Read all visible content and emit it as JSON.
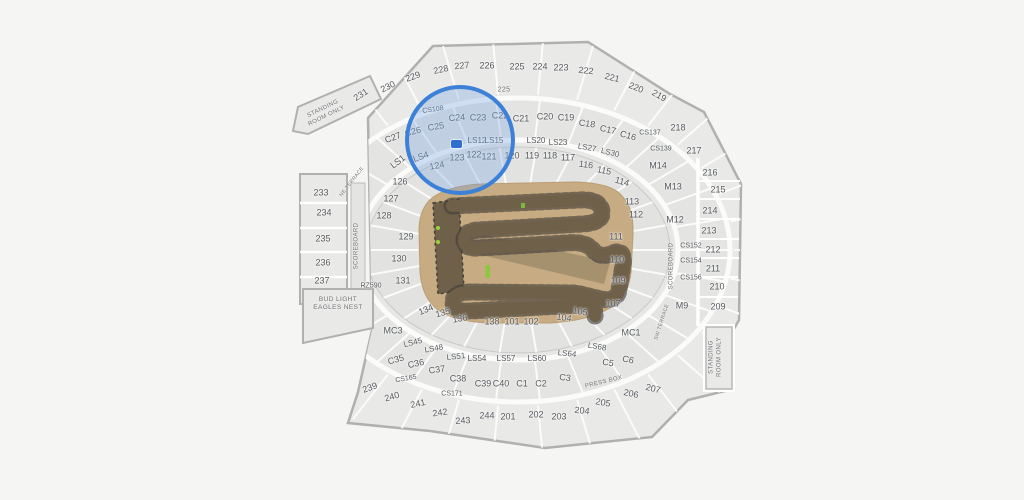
{
  "map": {
    "colors": {
      "background": "#f5f5f3",
      "section_fill": "#e9e9e7",
      "section_stroke": "#b0b0ae",
      "label": "#55585d",
      "highlight_stroke": "#3c80d8",
      "highlight_fill": "rgba(126,168,226,0.35)",
      "marker": "#2e6fd0",
      "field_base": "#c7ab82",
      "track": "#6e6049",
      "track_edge": "#45403a",
      "start_gate_green": "#8dc63f"
    },
    "highlight": {
      "cx": 460,
      "cy": 140,
      "r": 55,
      "marker_x": 456,
      "marker_y": 144
    },
    "sections": [
      {
        "l": "231",
        "x": 361,
        "y": 95,
        "r": -33
      },
      {
        "l": "230",
        "x": 388,
        "y": 87,
        "r": -27
      },
      {
        "l": "229",
        "x": 413,
        "y": 77,
        "r": -20
      },
      {
        "l": "228",
        "x": 441,
        "y": 70,
        "r": -12
      },
      {
        "l": "227",
        "x": 462,
        "y": 66,
        "r": -6
      },
      {
        "l": "226",
        "x": 487,
        "y": 66,
        "r": 0
      },
      {
        "l": "225",
        "x": 517,
        "y": 67,
        "r": 0
      },
      {
        "l": "224",
        "x": 540,
        "y": 67,
        "r": 0
      },
      {
        "l": "223",
        "x": 561,
        "y": 68,
        "r": 0
      },
      {
        "l": "222",
        "x": 586,
        "y": 71,
        "r": 6
      },
      {
        "l": "221",
        "x": 612,
        "y": 78,
        "r": 14
      },
      {
        "l": "220",
        "x": 636,
        "y": 88,
        "r": 22
      },
      {
        "l": "219",
        "x": 659,
        "y": 96,
        "r": 30
      },
      {
        "l": "CS108",
        "x": 433,
        "y": 110,
        "r": -8
      },
      {
        "l": "C25",
        "x": 436,
        "y": 127,
        "r": -10
      },
      {
        "l": "C26",
        "x": 413,
        "y": 132,
        "r": -14
      },
      {
        "l": "C27",
        "x": 393,
        "y": 138,
        "r": -20
      },
      {
        "l": "C24",
        "x": 457,
        "y": 118,
        "r": -4
      },
      {
        "l": "C23",
        "x": 478,
        "y": 118,
        "r": 0
      },
      {
        "l": "C22",
        "x": 500,
        "y": 116,
        "r": 0
      },
      {
        "l": "C21",
        "x": 521,
        "y": 119,
        "r": 0
      },
      {
        "l": "C20",
        "x": 545,
        "y": 117,
        "r": 0
      },
      {
        "l": "C19",
        "x": 566,
        "y": 118,
        "r": 0
      },
      {
        "l": "C18",
        "x": 587,
        "y": 124,
        "r": 8
      },
      {
        "l": "C17",
        "x": 608,
        "y": 130,
        "r": 12
      },
      {
        "l": "C16",
        "x": 628,
        "y": 136,
        "r": 16
      },
      {
        "l": "CS137",
        "x": 650,
        "y": 133,
        "r": 0
      },
      {
        "l": "CS139",
        "x": 661,
        "y": 149,
        "r": 0
      },
      {
        "l": "LS1",
        "x": 398,
        "y": 162,
        "r": -38
      },
      {
        "l": "LS4",
        "x": 421,
        "y": 157,
        "r": -20
      },
      {
        "l": "LS12",
        "x": 477,
        "y": 141,
        "r": 0
      },
      {
        "l": "LS15",
        "x": 494,
        "y": 141,
        "r": 0
      },
      {
        "l": "LS20",
        "x": 536,
        "y": 141,
        "r": 0
      },
      {
        "l": "LS23",
        "x": 558,
        "y": 143,
        "r": 0
      },
      {
        "l": "LS27",
        "x": 587,
        "y": 148,
        "r": 10
      },
      {
        "l": "LS30",
        "x": 610,
        "y": 153,
        "r": 14
      },
      {
        "l": "126",
        "x": 400,
        "y": 182,
        "r": 0
      },
      {
        "l": "127",
        "x": 391,
        "y": 199,
        "r": 0
      },
      {
        "l": "128",
        "x": 384,
        "y": 216,
        "r": 0
      },
      {
        "l": "129",
        "x": 406,
        "y": 237,
        "r": 0
      },
      {
        "l": "130",
        "x": 399,
        "y": 259,
        "r": 0
      },
      {
        "l": "131",
        "x": 403,
        "y": 281,
        "r": 0
      },
      {
        "l": "124",
        "x": 437,
        "y": 166,
        "r": -10
      },
      {
        "l": "123",
        "x": 457,
        "y": 158,
        "r": 0
      },
      {
        "l": "122",
        "x": 474,
        "y": 155,
        "r": 0
      },
      {
        "l": "121",
        "x": 489,
        "y": 157,
        "r": 0
      },
      {
        "l": "120",
        "x": 512,
        "y": 156,
        "r": 0
      },
      {
        "l": "119",
        "x": 532,
        "y": 156,
        "r": 0
      },
      {
        "l": "118",
        "x": 550,
        "y": 156,
        "r": 0
      },
      {
        "l": "117",
        "x": 568,
        "y": 158,
        "r": 0
      },
      {
        "l": "116",
        "x": 586,
        "y": 165,
        "r": 8
      },
      {
        "l": "115",
        "x": 604,
        "y": 171,
        "r": 12
      },
      {
        "l": "114",
        "x": 622,
        "y": 182,
        "r": 16
      },
      {
        "l": "113",
        "x": 632,
        "y": 202,
        "r": 0
      },
      {
        "l": "112",
        "x": 636,
        "y": 215,
        "r": 0
      },
      {
        "l": "111",
        "x": 616,
        "y": 237,
        "r": 0
      },
      {
        "l": "110",
        "x": 617,
        "y": 260,
        "r": 0
      },
      {
        "l": "109",
        "x": 618,
        "y": 281,
        "r": 0
      },
      {
        "l": "107",
        "x": 613,
        "y": 304,
        "r": 0
      },
      {
        "l": "105",
        "x": 580,
        "y": 312,
        "r": 10
      },
      {
        "l": "104",
        "x": 564,
        "y": 318,
        "r": 8
      },
      {
        "l": "101",
        "x": 512,
        "y": 322,
        "r": 0
      },
      {
        "l": "102",
        "x": 531,
        "y": 322,
        "r": 0
      },
      {
        "l": "138",
        "x": 492,
        "y": 322,
        "r": 0
      },
      {
        "l": "136",
        "x": 460,
        "y": 319,
        "r": -10
      },
      {
        "l": "135",
        "x": 443,
        "y": 313,
        "r": -16
      },
      {
        "l": "134",
        "x": 426,
        "y": 310,
        "r": -22
      },
      {
        "l": "M14",
        "x": 658,
        "y": 166,
        "r": 0
      },
      {
        "l": "M13",
        "x": 673,
        "y": 187,
        "r": 0
      },
      {
        "l": "M12",
        "x": 675,
        "y": 220,
        "r": 0
      },
      {
        "l": "M9",
        "x": 682,
        "y": 306,
        "r": 0
      },
      {
        "l": "MC1",
        "x": 631,
        "y": 333,
        "r": 0
      },
      {
        "l": "MC3",
        "x": 393,
        "y": 331,
        "r": 0
      },
      {
        "l": "RZ590",
        "x": 371,
        "y": 286,
        "r": 0
      },
      {
        "l": "CS152",
        "x": 691,
        "y": 246,
        "r": 0
      },
      {
        "l": "CS154",
        "x": 691,
        "y": 261,
        "r": 0
      },
      {
        "l": "CS156",
        "x": 691,
        "y": 278,
        "r": 0
      },
      {
        "l": "218",
        "x": 678,
        "y": 128,
        "r": 0
      },
      {
        "l": "217",
        "x": 694,
        "y": 151,
        "r": 0
      },
      {
        "l": "216",
        "x": 710,
        "y": 173,
        "r": 0
      },
      {
        "l": "215",
        "x": 718,
        "y": 190,
        "r": 0
      },
      {
        "l": "214",
        "x": 710,
        "y": 211,
        "r": 0
      },
      {
        "l": "213",
        "x": 709,
        "y": 231,
        "r": 0
      },
      {
        "l": "212",
        "x": 713,
        "y": 250,
        "r": 0
      },
      {
        "l": "211",
        "x": 713,
        "y": 269,
        "r": 0
      },
      {
        "l": "210",
        "x": 717,
        "y": 287,
        "r": 0
      },
      {
        "l": "209",
        "x": 718,
        "y": 307,
        "r": 0
      },
      {
        "l": "233",
        "x": 321,
        "y": 193,
        "r": 0
      },
      {
        "l": "234",
        "x": 324,
        "y": 213,
        "r": 0
      },
      {
        "l": "235",
        "x": 323,
        "y": 239,
        "r": 0
      },
      {
        "l": "236",
        "x": 323,
        "y": 263,
        "r": 0
      },
      {
        "l": "237",
        "x": 322,
        "y": 281,
        "r": 0
      },
      {
        "l": "LS45",
        "x": 413,
        "y": 343,
        "r": -14
      },
      {
        "l": "LS48",
        "x": 434,
        "y": 349,
        "r": -10
      },
      {
        "l": "LS51",
        "x": 456,
        "y": 357,
        "r": -6
      },
      {
        "l": "LS54",
        "x": 477,
        "y": 359,
        "r": 0
      },
      {
        "l": "LS57",
        "x": 506,
        "y": 359,
        "r": 0
      },
      {
        "l": "LS60",
        "x": 537,
        "y": 359,
        "r": 0
      },
      {
        "l": "LS64",
        "x": 567,
        "y": 354,
        "r": 6
      },
      {
        "l": "LS68",
        "x": 597,
        "y": 347,
        "r": 10
      },
      {
        "l": "C35",
        "x": 396,
        "y": 360,
        "r": -16
      },
      {
        "l": "C36",
        "x": 416,
        "y": 364,
        "r": -12
      },
      {
        "l": "C37",
        "x": 437,
        "y": 370,
        "r": -8
      },
      {
        "l": "C38",
        "x": 458,
        "y": 379,
        "r": 0
      },
      {
        "l": "C39",
        "x": 483,
        "y": 384,
        "r": 0
      },
      {
        "l": "C40",
        "x": 501,
        "y": 384,
        "r": 0
      },
      {
        "l": "C1",
        "x": 522,
        "y": 384,
        "r": 0
      },
      {
        "l": "C2",
        "x": 541,
        "y": 384,
        "r": 0
      },
      {
        "l": "C3",
        "x": 565,
        "y": 378,
        "r": 6
      },
      {
        "l": "C5",
        "x": 608,
        "y": 363,
        "r": 10
      },
      {
        "l": "C6",
        "x": 628,
        "y": 360,
        "r": 12
      },
      {
        "l": "CS165",
        "x": 406,
        "y": 379,
        "r": -10
      },
      {
        "l": "CS171",
        "x": 452,
        "y": 394,
        "r": 0
      },
      {
        "l": "239",
        "x": 370,
        "y": 388,
        "r": -20
      },
      {
        "l": "240",
        "x": 392,
        "y": 397,
        "r": -16
      },
      {
        "l": "241",
        "x": 418,
        "y": 404,
        "r": -12
      },
      {
        "l": "242",
        "x": 440,
        "y": 413,
        "r": -8
      },
      {
        "l": "243",
        "x": 463,
        "y": 421,
        "r": -4
      },
      {
        "l": "244",
        "x": 487,
        "y": 416,
        "r": 0
      },
      {
        "l": "201",
        "x": 508,
        "y": 417,
        "r": 0
      },
      {
        "l": "202",
        "x": 536,
        "y": 415,
        "r": 0
      },
      {
        "l": "203",
        "x": 559,
        "y": 417,
        "r": 0
      },
      {
        "l": "204",
        "x": 582,
        "y": 411,
        "r": 6
      },
      {
        "l": "205",
        "x": 603,
        "y": 403,
        "r": 10
      },
      {
        "l": "206",
        "x": 631,
        "y": 394,
        "r": 12
      },
      {
        "l": "207",
        "x": 653,
        "y": 389,
        "r": 14
      }
    ],
    "features": [
      {
        "name": "standing-room-only-left",
        "text": "STANDING\nROOM ONLY",
        "x": 325,
        "y": 113,
        "rot": -26,
        "size": 6
      },
      {
        "name": "standing-room-only-right",
        "text": "STANDING\nROOM ONLY",
        "x": 716,
        "y": 357,
        "rot": -90,
        "size": 6
      },
      {
        "name": "scoreboard-left",
        "text": "SCOREBOARD",
        "x": 357,
        "y": 246,
        "rot": -90,
        "size": 6
      },
      {
        "name": "scoreboard-right",
        "text": "SCOREBOARD",
        "x": 672,
        "y": 266,
        "rot": -90,
        "size": 6
      },
      {
        "name": "ne-terrace",
        "text": "NE TERRACE",
        "x": 352,
        "y": 182,
        "rot": -52,
        "size": 5
      },
      {
        "name": "sw-terrace",
        "text": "SW TERRACE",
        "x": 662,
        "y": 322,
        "rot": -72,
        "size": 5
      },
      {
        "name": "press-box",
        "text": "PRESS BOX",
        "x": 604,
        "y": 383,
        "rot": -14,
        "size": 6
      },
      {
        "name": "bud-light-eagles-nest",
        "text": "BUD LIGHT\nEAGLES NEST",
        "x": 338,
        "y": 304,
        "rot": 0,
        "size": 6.5
      },
      {
        "name": "tunnel-225",
        "text": "225",
        "x": 504,
        "y": 91,
        "rot": 0,
        "size": 7
      }
    ]
  }
}
